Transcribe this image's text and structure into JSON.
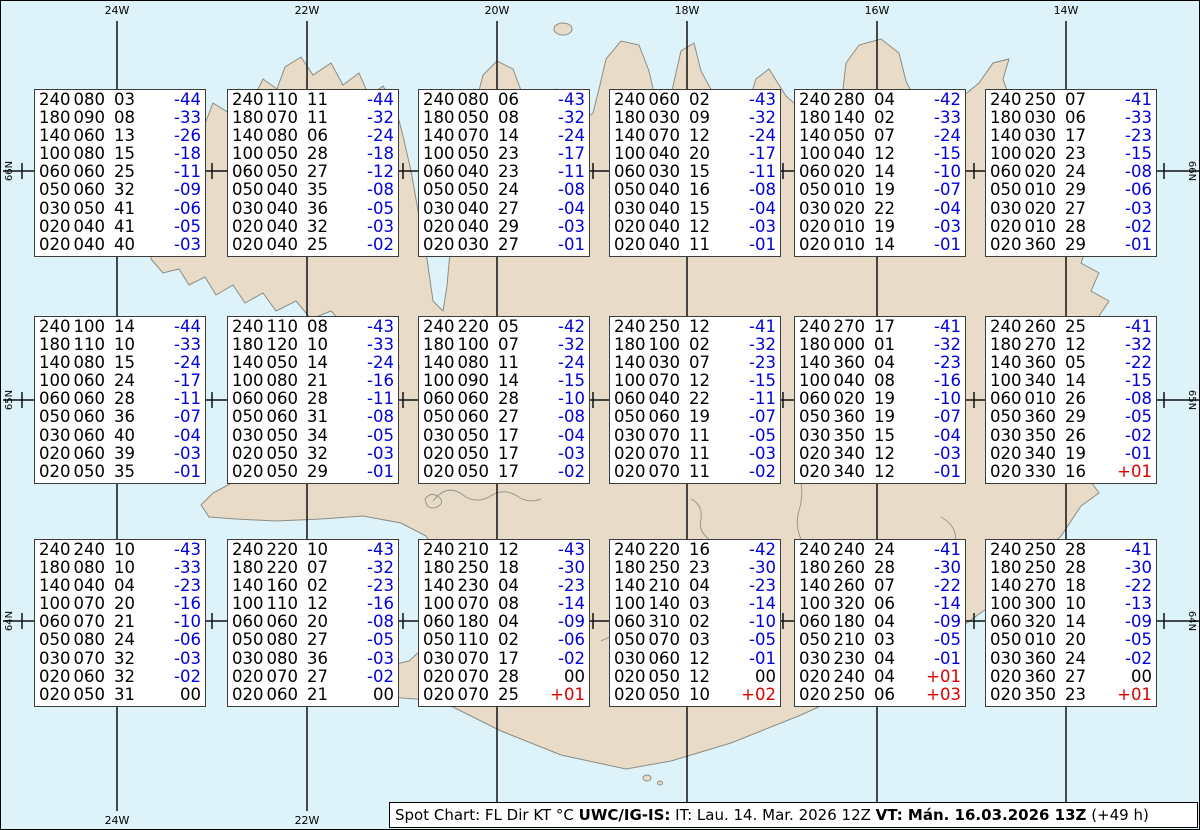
{
  "title": "Spot Chart",
  "colors": {
    "ocean": "#def3f9",
    "land": "#e8dcc8",
    "coastline": "#8c8c84",
    "grid": "#111111",
    "temp_negative": "#0000dd",
    "temp_positive": "#dd0000",
    "temp_zero": "#000000",
    "box_background": "#ffffff",
    "box_border": "#3c3c3c"
  },
  "grid": {
    "meridians": [
      {
        "label": "24W",
        "x": 116
      },
      {
        "label": "22W",
        "x": 306
      },
      {
        "label": "20W",
        "x": 496
      },
      {
        "label": "18W",
        "x": 686
      },
      {
        "label": "16W",
        "x": 876
      },
      {
        "label": "14W",
        "x": 1065
      }
    ],
    "parallels": [
      {
        "label": "66N",
        "y": 170
      },
      {
        "label": "65N",
        "y": 399
      },
      {
        "label": "64N",
        "y": 620
      }
    ],
    "tick_xs": [
      21,
      116,
      211,
      306,
      402,
      497,
      592,
      687,
      782,
      878,
      973,
      1068,
      1163
    ]
  },
  "stations": [
    {
      "x": 33,
      "y": 88,
      "rows": [
        [
          "240",
          "080",
          "03",
          "-44"
        ],
        [
          "180",
          "090",
          "08",
          "-33"
        ],
        [
          "140",
          "060",
          "13",
          "-26"
        ],
        [
          "100",
          "080",
          "15",
          "-18"
        ],
        [
          "060",
          "060",
          "25",
          "-11"
        ],
        [
          "050",
          "060",
          "32",
          "-09"
        ],
        [
          "030",
          "050",
          "41",
          "-06"
        ],
        [
          "020",
          "040",
          "41",
          "-05"
        ],
        [
          "020",
          "040",
          "40",
          "-03"
        ]
      ]
    },
    {
      "x": 226,
      "y": 88,
      "rows": [
        [
          "240",
          "110",
          "11",
          "-44"
        ],
        [
          "180",
          "070",
          "11",
          "-32"
        ],
        [
          "140",
          "080",
          "06",
          "-24"
        ],
        [
          "100",
          "050",
          "28",
          "-18"
        ],
        [
          "060",
          "050",
          "27",
          "-12"
        ],
        [
          "050",
          "040",
          "35",
          "-08"
        ],
        [
          "030",
          "040",
          "36",
          "-05"
        ],
        [
          "020",
          "040",
          "32",
          "-03"
        ],
        [
          "020",
          "040",
          "25",
          "-02"
        ]
      ]
    },
    {
      "x": 417,
      "y": 88,
      "rows": [
        [
          "240",
          "080",
          "06",
          "-43"
        ],
        [
          "180",
          "050",
          "08",
          "-32"
        ],
        [
          "140",
          "070",
          "14",
          "-24"
        ],
        [
          "100",
          "050",
          "23",
          "-17"
        ],
        [
          "060",
          "040",
          "23",
          "-11"
        ],
        [
          "050",
          "050",
          "24",
          "-08"
        ],
        [
          "030",
          "040",
          "27",
          "-04"
        ],
        [
          "020",
          "040",
          "29",
          "-03"
        ],
        [
          "020",
          "030",
          "27",
          "-01"
        ]
      ]
    },
    {
      "x": 608,
      "y": 88,
      "rows": [
        [
          "240",
          "060",
          "02",
          "-43"
        ],
        [
          "180",
          "030",
          "09",
          "-32"
        ],
        [
          "140",
          "070",
          "12",
          "-24"
        ],
        [
          "100",
          "040",
          "20",
          "-17"
        ],
        [
          "060",
          "030",
          "15",
          "-11"
        ],
        [
          "050",
          "040",
          "16",
          "-08"
        ],
        [
          "030",
          "040",
          "15",
          "-04"
        ],
        [
          "020",
          "040",
          "12",
          "-03"
        ],
        [
          "020",
          "040",
          "11",
          "-01"
        ]
      ]
    },
    {
      "x": 793,
      "y": 88,
      "rows": [
        [
          "240",
          "280",
          "04",
          "-42"
        ],
        [
          "180",
          "140",
          "02",
          "-33"
        ],
        [
          "140",
          "050",
          "07",
          "-24"
        ],
        [
          "100",
          "040",
          "12",
          "-15"
        ],
        [
          "060",
          "020",
          "14",
          "-10"
        ],
        [
          "050",
          "010",
          "19",
          "-07"
        ],
        [
          "030",
          "020",
          "22",
          "-04"
        ],
        [
          "020",
          "010",
          "19",
          "-03"
        ],
        [
          "020",
          "010",
          "14",
          "-01"
        ]
      ]
    },
    {
      "x": 984,
      "y": 88,
      "rows": [
        [
          "240",
          "250",
          "07",
          "-41"
        ],
        [
          "180",
          "030",
          "06",
          "-33"
        ],
        [
          "140",
          "030",
          "17",
          "-23"
        ],
        [
          "100",
          "020",
          "23",
          "-15"
        ],
        [
          "060",
          "020",
          "24",
          "-08"
        ],
        [
          "050",
          "010",
          "29",
          "-06"
        ],
        [
          "030",
          "020",
          "27",
          "-03"
        ],
        [
          "020",
          "010",
          "28",
          "-02"
        ],
        [
          "020",
          "360",
          "29",
          "-01"
        ]
      ]
    },
    {
      "x": 33,
      "y": 315,
      "rows": [
        [
          "240",
          "100",
          "14",
          "-44"
        ],
        [
          "180",
          "110",
          "10",
          "-33"
        ],
        [
          "140",
          "080",
          "15",
          "-24"
        ],
        [
          "100",
          "060",
          "24",
          "-17"
        ],
        [
          "060",
          "060",
          "28",
          "-11"
        ],
        [
          "050",
          "060",
          "36",
          "-07"
        ],
        [
          "030",
          "060",
          "40",
          "-04"
        ],
        [
          "020",
          "060",
          "39",
          "-03"
        ],
        [
          "020",
          "050",
          "35",
          "-01"
        ]
      ]
    },
    {
      "x": 226,
      "y": 315,
      "rows": [
        [
          "240",
          "110",
          "08",
          "-43"
        ],
        [
          "180",
          "120",
          "10",
          "-33"
        ],
        [
          "140",
          "050",
          "14",
          "-24"
        ],
        [
          "100",
          "080",
          "21",
          "-16"
        ],
        [
          "060",
          "060",
          "28",
          "-11"
        ],
        [
          "050",
          "060",
          "31",
          "-08"
        ],
        [
          "030",
          "050",
          "34",
          "-05"
        ],
        [
          "020",
          "050",
          "32",
          "-03"
        ],
        [
          "020",
          "050",
          "29",
          "-01"
        ]
      ]
    },
    {
      "x": 417,
      "y": 315,
      "rows": [
        [
          "240",
          "220",
          "05",
          "-42"
        ],
        [
          "180",
          "100",
          "07",
          "-32"
        ],
        [
          "140",
          "080",
          "11",
          "-24"
        ],
        [
          "100",
          "090",
          "14",
          "-15"
        ],
        [
          "060",
          "060",
          "28",
          "-10"
        ],
        [
          "050",
          "060",
          "27",
          "-08"
        ],
        [
          "030",
          "050",
          "17",
          "-04"
        ],
        [
          "020",
          "050",
          "17",
          "-03"
        ],
        [
          "020",
          "050",
          "17",
          "-02"
        ]
      ]
    },
    {
      "x": 608,
      "y": 315,
      "rows": [
        [
          "240",
          "250",
          "12",
          "-41"
        ],
        [
          "180",
          "100",
          "02",
          "-32"
        ],
        [
          "140",
          "030",
          "07",
          "-23"
        ],
        [
          "100",
          "070",
          "12",
          "-15"
        ],
        [
          "060",
          "040",
          "22",
          "-11"
        ],
        [
          "050",
          "060",
          "19",
          "-07"
        ],
        [
          "030",
          "070",
          "11",
          "-05"
        ],
        [
          "020",
          "070",
          "11",
          "-03"
        ],
        [
          "020",
          "070",
          "11",
          "-02"
        ]
      ]
    },
    {
      "x": 793,
      "y": 315,
      "rows": [
        [
          "240",
          "270",
          "17",
          "-41"
        ],
        [
          "180",
          "000",
          "01",
          "-32"
        ],
        [
          "140",
          "360",
          "04",
          "-23"
        ],
        [
          "100",
          "040",
          "08",
          "-16"
        ],
        [
          "060",
          "020",
          "19",
          "-10"
        ],
        [
          "050",
          "360",
          "19",
          "-07"
        ],
        [
          "030",
          "350",
          "15",
          "-04"
        ],
        [
          "020",
          "340",
          "12",
          "-03"
        ],
        [
          "020",
          "340",
          "12",
          "-01"
        ]
      ]
    },
    {
      "x": 984,
      "y": 315,
      "rows": [
        [
          "240",
          "260",
          "25",
          "-41"
        ],
        [
          "180",
          "270",
          "12",
          "-32"
        ],
        [
          "140",
          "360",
          "05",
          "-22"
        ],
        [
          "100",
          "340",
          "14",
          "-15"
        ],
        [
          "060",
          "010",
          "26",
          "-08"
        ],
        [
          "050",
          "360",
          "29",
          "-05"
        ],
        [
          "030",
          "350",
          "26",
          "-02"
        ],
        [
          "020",
          "340",
          "19",
          "-01"
        ],
        [
          "020",
          "330",
          "16",
          "+01"
        ]
      ]
    },
    {
      "x": 33,
      "y": 538,
      "rows": [
        [
          "240",
          "240",
          "10",
          "-43"
        ],
        [
          "180",
          "080",
          "10",
          "-33"
        ],
        [
          "140",
          "040",
          "04",
          "-23"
        ],
        [
          "100",
          "070",
          "20",
          "-16"
        ],
        [
          "060",
          "070",
          "21",
          "-10"
        ],
        [
          "050",
          "080",
          "24",
          "-06"
        ],
        [
          "030",
          "070",
          "32",
          "-03"
        ],
        [
          "020",
          "060",
          "32",
          "-02"
        ],
        [
          "020",
          "050",
          "31",
          "00"
        ]
      ]
    },
    {
      "x": 226,
      "y": 538,
      "rows": [
        [
          "240",
          "220",
          "10",
          "-43"
        ],
        [
          "180",
          "220",
          "07",
          "-32"
        ],
        [
          "140",
          "160",
          "02",
          "-23"
        ],
        [
          "100",
          "110",
          "12",
          "-16"
        ],
        [
          "060",
          "060",
          "20",
          "-08"
        ],
        [
          "050",
          "080",
          "27",
          "-05"
        ],
        [
          "030",
          "080",
          "36",
          "-03"
        ],
        [
          "020",
          "070",
          "27",
          "-02"
        ],
        [
          "020",
          "060",
          "21",
          "00"
        ]
      ]
    },
    {
      "x": 417,
      "y": 538,
      "rows": [
        [
          "240",
          "210",
          "12",
          "-43"
        ],
        [
          "180",
          "250",
          "18",
          "-30"
        ],
        [
          "140",
          "230",
          "04",
          "-23"
        ],
        [
          "100",
          "070",
          "08",
          "-14"
        ],
        [
          "060",
          "180",
          "04",
          "-09"
        ],
        [
          "050",
          "110",
          "02",
          "-06"
        ],
        [
          "030",
          "070",
          "17",
          "-02"
        ],
        [
          "020",
          "070",
          "28",
          "00"
        ],
        [
          "020",
          "070",
          "25",
          "+01"
        ]
      ]
    },
    {
      "x": 608,
      "y": 538,
      "rows": [
        [
          "240",
          "220",
          "16",
          "-42"
        ],
        [
          "180",
          "250",
          "23",
          "-30"
        ],
        [
          "140",
          "210",
          "04",
          "-23"
        ],
        [
          "100",
          "140",
          "03",
          "-14"
        ],
        [
          "060",
          "310",
          "02",
          "-10"
        ],
        [
          "050",
          "070",
          "03",
          "-05"
        ],
        [
          "030",
          "060",
          "12",
          "-01"
        ],
        [
          "020",
          "050",
          "12",
          "00"
        ],
        [
          "020",
          "050",
          "10",
          "+02"
        ]
      ]
    },
    {
      "x": 793,
      "y": 538,
      "rows": [
        [
          "240",
          "240",
          "24",
          "-41"
        ],
        [
          "180",
          "260",
          "28",
          "-30"
        ],
        [
          "140",
          "260",
          "07",
          "-22"
        ],
        [
          "100",
          "320",
          "06",
          "-14"
        ],
        [
          "060",
          "180",
          "04",
          "-09"
        ],
        [
          "050",
          "210",
          "03",
          "-05"
        ],
        [
          "030",
          "230",
          "04",
          "-01"
        ],
        [
          "020",
          "240",
          "04",
          "+01"
        ],
        [
          "020",
          "250",
          "06",
          "+03"
        ]
      ]
    },
    {
      "x": 984,
      "y": 538,
      "rows": [
        [
          "240",
          "250",
          "28",
          "-41"
        ],
        [
          "180",
          "250",
          "28",
          "-30"
        ],
        [
          "140",
          "270",
          "18",
          "-22"
        ],
        [
          "100",
          "300",
          "10",
          "-13"
        ],
        [
          "060",
          "320",
          "14",
          "-09"
        ],
        [
          "050",
          "010",
          "20",
          "-05"
        ],
        [
          "030",
          "360",
          "24",
          "-02"
        ],
        [
          "020",
          "360",
          "27",
          "00"
        ],
        [
          "020",
          "350",
          "23",
          "+01"
        ]
      ]
    }
  ],
  "footer": {
    "segments": [
      {
        "text": "Spot Chart: FL Dir KT °C ",
        "bold": false
      },
      {
        "text": "UWC/IG-IS:",
        "bold": true
      },
      {
        "text": " IT: Lau. 14. Mar. 2026 12Z ",
        "bold": false
      },
      {
        "text": "VT: Mán. 16.03.2026 13Z",
        "bold": true
      },
      {
        "text": " (+49 h)",
        "bold": false
      }
    ]
  }
}
